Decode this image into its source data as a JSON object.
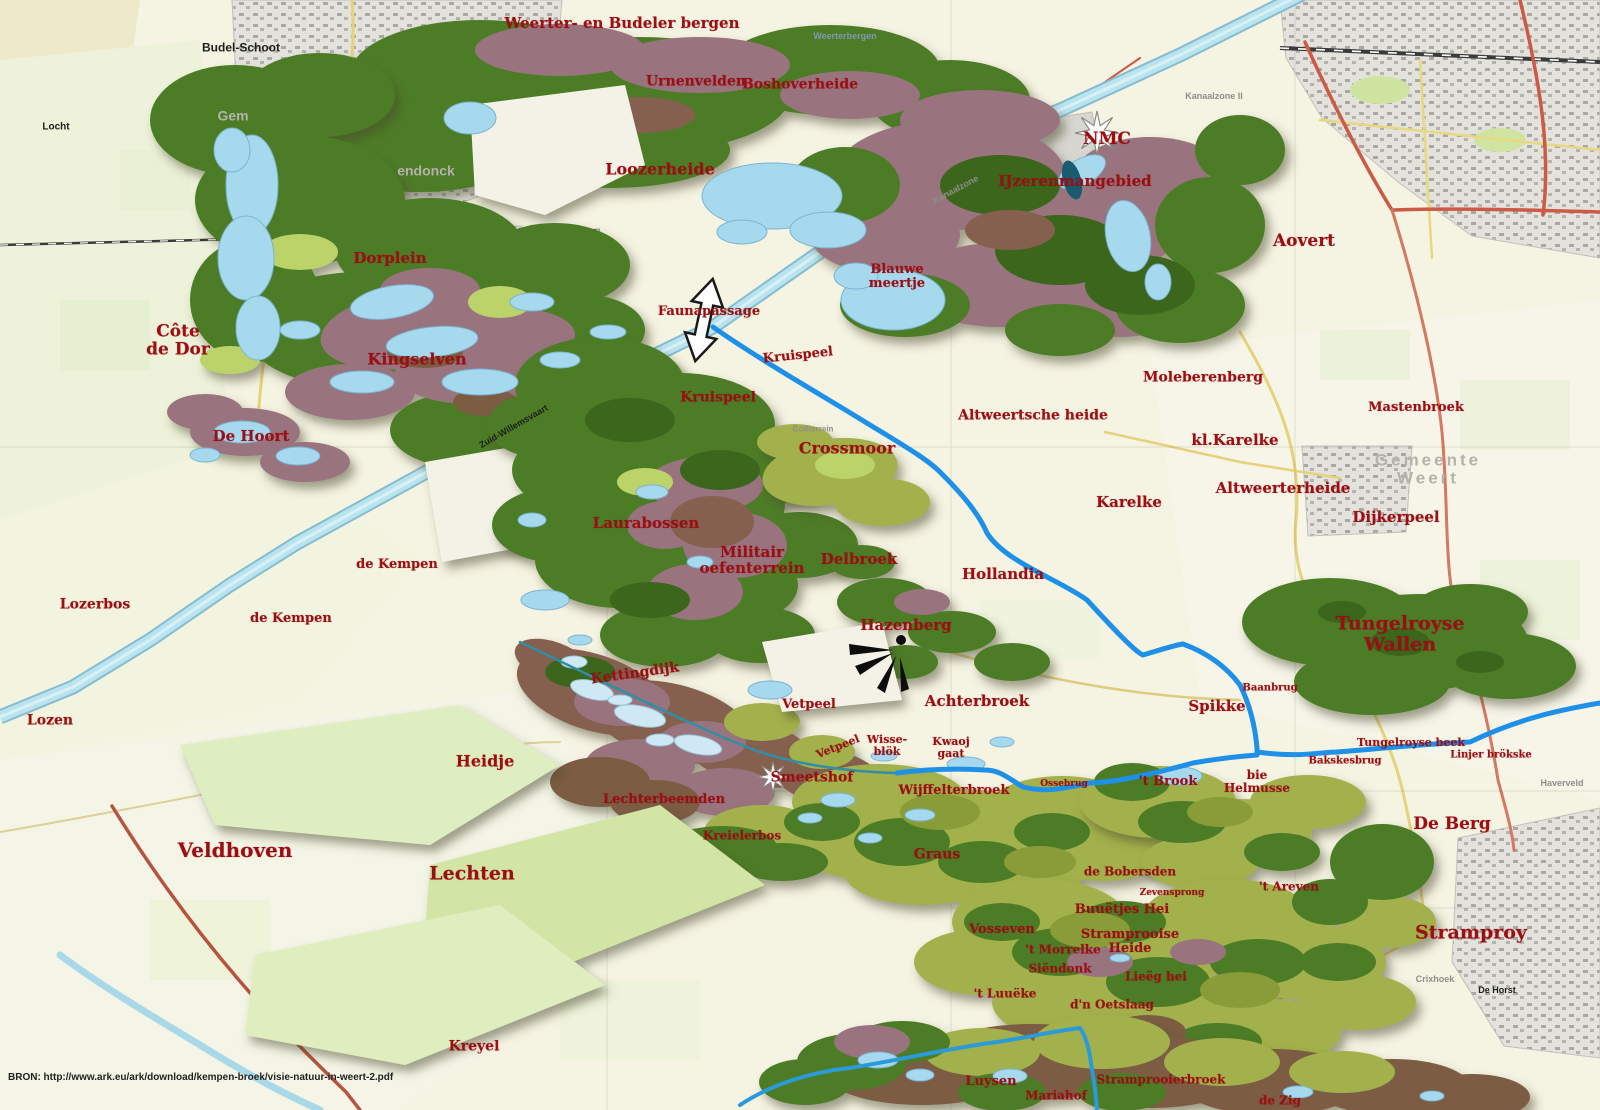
{
  "map": {
    "source_note": "BRON: http://www.ark.eu/ark/download/kempen-broek/visie-natuur-in-weert-2.pdf",
    "colors": {
      "label_red": "#9e0d12",
      "topo_black": "#1d1d1b",
      "topo_gray": "#8e8e88",
      "municipality_gray": "#b3b2ab",
      "water_river": "#1e90e8",
      "water_canal": "#b9e4ef",
      "forest_green": "#4e7c27",
      "heath_purple": "#99737e",
      "meadow_olive": "#a2b14c",
      "broek_brown": "#7b5b43"
    },
    "place_labels": [
      {
        "t": "Weerter- en Budeler bergen",
        "x": 622,
        "y": 23,
        "s": 15
      },
      {
        "t": "Urnenvelden",
        "x": 696,
        "y": 82,
        "s": 14
      },
      {
        "t": "Boshoverheide",
        "x": 800,
        "y": 85,
        "s": 14
      },
      {
        "t": "Loozerheide",
        "x": 660,
        "y": 169,
        "s": 16
      },
      {
        "t": "NMC",
        "x": 1107,
        "y": 139,
        "s": 17
      },
      {
        "t": "IJzerenmangebied",
        "x": 1075,
        "y": 181,
        "s": 15
      },
      {
        "t": "Aovert",
        "x": 1304,
        "y": 241,
        "s": 17
      },
      {
        "t": "Dorplein",
        "x": 390,
        "y": 258,
        "s": 15
      },
      {
        "t": "Côte\nde Dor",
        "x": 178,
        "y": 341,
        "s": 17
      },
      {
        "t": "Kingselven",
        "x": 417,
        "y": 359,
        "s": 16
      },
      {
        "t": "De Hoort",
        "x": 251,
        "y": 436,
        "s": 15
      },
      {
        "t": "Faunapassage",
        "x": 709,
        "y": 312,
        "s": 13
      },
      {
        "t": "Blauwe\nmeertje",
        "x": 897,
        "y": 277,
        "s": 13
      },
      {
        "t": "Kruispeel",
        "x": 798,
        "y": 356,
        "s": 13,
        "r": -6
      },
      {
        "t": "Kruispeel",
        "x": 718,
        "y": 398,
        "s": 14
      },
      {
        "t": "Crossmoor",
        "x": 847,
        "y": 448,
        "s": 16
      },
      {
        "t": "Altweertsche heide",
        "x": 1033,
        "y": 416,
        "s": 14
      },
      {
        "t": "Moleberenberg",
        "x": 1203,
        "y": 378,
        "s": 14
      },
      {
        "t": "Mastenbroek",
        "x": 1416,
        "y": 408,
        "s": 13
      },
      {
        "t": "kl.Karelke",
        "x": 1235,
        "y": 440,
        "s": 15
      },
      {
        "t": "Karelke",
        "x": 1129,
        "y": 502,
        "s": 15
      },
      {
        "t": "Altweerterheide",
        "x": 1283,
        "y": 488,
        "s": 15
      },
      {
        "t": "Dijkerpeel",
        "x": 1396,
        "y": 517,
        "s": 15
      },
      {
        "t": "Laurabossen",
        "x": 646,
        "y": 523,
        "s": 15
      },
      {
        "t": "de Kempen",
        "x": 397,
        "y": 565,
        "s": 13
      },
      {
        "t": "Militair\noefenterrein",
        "x": 752,
        "y": 560,
        "s": 15
      },
      {
        "t": "Delbroek",
        "x": 859,
        "y": 559,
        "s": 15
      },
      {
        "t": "Hollandia",
        "x": 1003,
        "y": 574,
        "s": 15
      },
      {
        "t": "de Kempen",
        "x": 291,
        "y": 619,
        "s": 13
      },
      {
        "t": "Lozerbos",
        "x": 95,
        "y": 605,
        "s": 14
      },
      {
        "t": "Hazenberg",
        "x": 906,
        "y": 625,
        "s": 15
      },
      {
        "t": "Tungelroyse Wallen",
        "x": 1400,
        "y": 634,
        "s": 19
      },
      {
        "t": "Lozen",
        "x": 50,
        "y": 721,
        "s": 14
      },
      {
        "t": "Kettingdijk",
        "x": 635,
        "y": 674,
        "s": 14,
        "r": -8
      },
      {
        "t": "Vetpeel",
        "x": 809,
        "y": 705,
        "s": 13
      },
      {
        "t": "Achterbroek",
        "x": 977,
        "y": 701,
        "s": 15
      },
      {
        "t": "Spikke",
        "x": 1217,
        "y": 706,
        "s": 15
      },
      {
        "t": "Baanbrug",
        "x": 1270,
        "y": 689,
        "s": 10
      },
      {
        "t": "Wisse-\nblök",
        "x": 887,
        "y": 746,
        "s": 11
      },
      {
        "t": "Kwaoj\ngaat",
        "x": 951,
        "y": 748,
        "s": 11
      },
      {
        "t": "Vetpeel",
        "x": 838,
        "y": 747,
        "s": 11,
        "r": -22
      },
      {
        "t": "Tungelroyse beek",
        "x": 1411,
        "y": 743,
        "s": 11
      },
      {
        "t": "Linjer brökske",
        "x": 1491,
        "y": 756,
        "s": 10
      },
      {
        "t": "Bakskesbrug",
        "x": 1345,
        "y": 762,
        "s": 10
      },
      {
        "t": "Heidje",
        "x": 485,
        "y": 761,
        "s": 16
      },
      {
        "t": "Smeetshof",
        "x": 812,
        "y": 778,
        "s": 14
      },
      {
        "t": "'t Brook",
        "x": 1168,
        "y": 782,
        "s": 13
      },
      {
        "t": "bie\nHelmusse",
        "x": 1257,
        "y": 782,
        "s": 12
      },
      {
        "t": "Wijffelterbroek",
        "x": 954,
        "y": 791,
        "s": 13
      },
      {
        "t": "Ossebrug",
        "x": 1064,
        "y": 785,
        "s": 9
      },
      {
        "t": "Lechterbeemden",
        "x": 664,
        "y": 800,
        "s": 13
      },
      {
        "t": "De Berg",
        "x": 1452,
        "y": 824,
        "s": 17
      },
      {
        "t": "Kreielerbos",
        "x": 742,
        "y": 836,
        "s": 12
      },
      {
        "t": "Graus",
        "x": 937,
        "y": 855,
        "s": 14
      },
      {
        "t": "Lechten",
        "x": 472,
        "y": 874,
        "s": 19
      },
      {
        "t": "de Bobersden",
        "x": 1130,
        "y": 872,
        "s": 12
      },
      {
        "t": "Zevensprong",
        "x": 1172,
        "y": 894,
        "s": 9
      },
      {
        "t": "'t Areven",
        "x": 1289,
        "y": 887,
        "s": 12
      },
      {
        "t": "Buuëtjes Hei",
        "x": 1122,
        "y": 910,
        "s": 13
      },
      {
        "t": "Vosseven",
        "x": 1002,
        "y": 930,
        "s": 13
      },
      {
        "t": "'t Morrelke",
        "x": 1063,
        "y": 950,
        "s": 12
      },
      {
        "t": "Stramprooise\nHeide",
        "x": 1130,
        "y": 942,
        "s": 13
      },
      {
        "t": "Stramproy",
        "x": 1471,
        "y": 933,
        "s": 19
      },
      {
        "t": "Siëndonk",
        "x": 1060,
        "y": 969,
        "s": 12
      },
      {
        "t": "Lieëg hei",
        "x": 1156,
        "y": 977,
        "s": 12
      },
      {
        "t": "'t Luuëke",
        "x": 1005,
        "y": 994,
        "s": 12
      },
      {
        "t": "d'n Oetslaag",
        "x": 1112,
        "y": 1005,
        "s": 12
      },
      {
        "t": "Veldhoven",
        "x": 235,
        "y": 851,
        "s": 20
      },
      {
        "t": "Kreyel",
        "x": 474,
        "y": 1047,
        "s": 14
      },
      {
        "t": "Luysen",
        "x": 991,
        "y": 1082,
        "s": 13
      },
      {
        "t": "Mariahof",
        "x": 1056,
        "y": 1096,
        "s": 12
      },
      {
        "t": "Stramprooierbroek",
        "x": 1161,
        "y": 1080,
        "s": 12
      },
      {
        "t": "de Zig",
        "x": 1280,
        "y": 1101,
        "s": 12
      }
    ],
    "topo_labels": [
      {
        "t": "Budel-Schoot",
        "x": 241,
        "y": 48,
        "s": 12,
        "c": "k"
      },
      {
        "t": "Locht",
        "x": 56,
        "y": 128,
        "s": 10,
        "c": "k"
      },
      {
        "t": "Gem",
        "x": 233,
        "y": 116,
        "s": 14,
        "c": "m"
      },
      {
        "t": "endonck",
        "x": 426,
        "y": 171,
        "s": 14,
        "c": "m"
      },
      {
        "t": "Weerterbergen",
        "x": 845,
        "y": 37,
        "s": 9,
        "c": "b"
      },
      {
        "t": "Kanaalzone II",
        "x": 1214,
        "y": 97,
        "s": 9,
        "c": "g"
      },
      {
        "t": "Kanaalzone",
        "x": 956,
        "y": 190,
        "s": 9,
        "c": "g",
        "r": -28
      },
      {
        "t": "Gemeente Weert",
        "x": 1428,
        "y": 470,
        "s": 17,
        "c": "m",
        "ls": 3
      },
      {
        "t": "Zuid-Willemsvaart",
        "x": 514,
        "y": 427,
        "s": 9,
        "c": "k",
        "r": -30
      },
      {
        "t": "Golfterrein",
        "x": 813,
        "y": 430,
        "s": 8,
        "c": "g"
      },
      {
        "t": "Crixhoek",
        "x": 1435,
        "y": 980,
        "s": 9,
        "c": "g"
      },
      {
        "t": "De Horst",
        "x": 1497,
        "y": 991,
        "s": 9,
        "c": "k"
      },
      {
        "t": "Haverveld",
        "x": 1562,
        "y": 784,
        "s": 9,
        "c": "g"
      }
    ],
    "icons": [
      {
        "name": "nmc-star-icon",
        "x": 1097,
        "y": 133
      },
      {
        "name": "smeetshof-star-icon",
        "x": 773,
        "y": 777
      },
      {
        "name": "faunapassage-arrow-icon",
        "x": 704,
        "y": 320
      },
      {
        "name": "hazenberg-beacon-icon",
        "x": 893,
        "y": 650
      }
    ]
  }
}
